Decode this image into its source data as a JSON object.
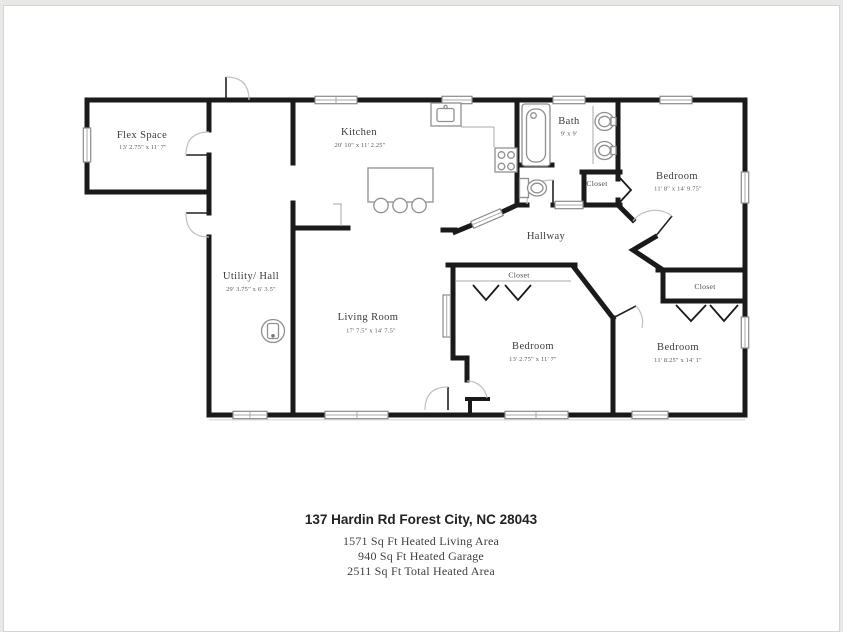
{
  "floorplan": {
    "rooms": [
      {
        "id": "flex-space",
        "name": "Flex Space",
        "dims": "13' 2.75\" x 11' 7\""
      },
      {
        "id": "kitchen",
        "name": "Kitchen",
        "dims": "20' 10\" x 11' 2.25\""
      },
      {
        "id": "bath",
        "name": "Bath",
        "dims": "9' x 9'"
      },
      {
        "id": "bedroom-ne",
        "name": "Bedroom",
        "dims": "11' 8\" x 14' 9.75\""
      },
      {
        "id": "hallway",
        "name": "Hallway",
        "dims": ""
      },
      {
        "id": "utility-hall",
        "name": "Utility/ Hall",
        "dims": "29' 3.75\" x 6' 3.5\""
      },
      {
        "id": "living-room",
        "name": "Living Room",
        "dims": "17' 7.5\" x 14' 7.5\""
      },
      {
        "id": "bedroom-south",
        "name": "Bedroom",
        "dims": "13' 2.75\" x 11' 7\""
      },
      {
        "id": "bedroom-se",
        "name": "Bedroom",
        "dims": "11' 8.25\" x 14' 1\""
      }
    ],
    "closets": [
      "Closet",
      "Closet",
      "Closet"
    ]
  },
  "footer": {
    "address": "137 Hardin Rd Forest City, NC 28043",
    "lines": [
      "1571 Sq Ft Heated Living Area",
      "940 Sq Ft Heated Garage",
      "2511 Sq Ft Total Heated Area"
    ]
  },
  "colors": {
    "wall": "#1a1a1a",
    "fixture": "#909090",
    "page": "#ffffff",
    "backdrop": "#e9e8e6"
  }
}
